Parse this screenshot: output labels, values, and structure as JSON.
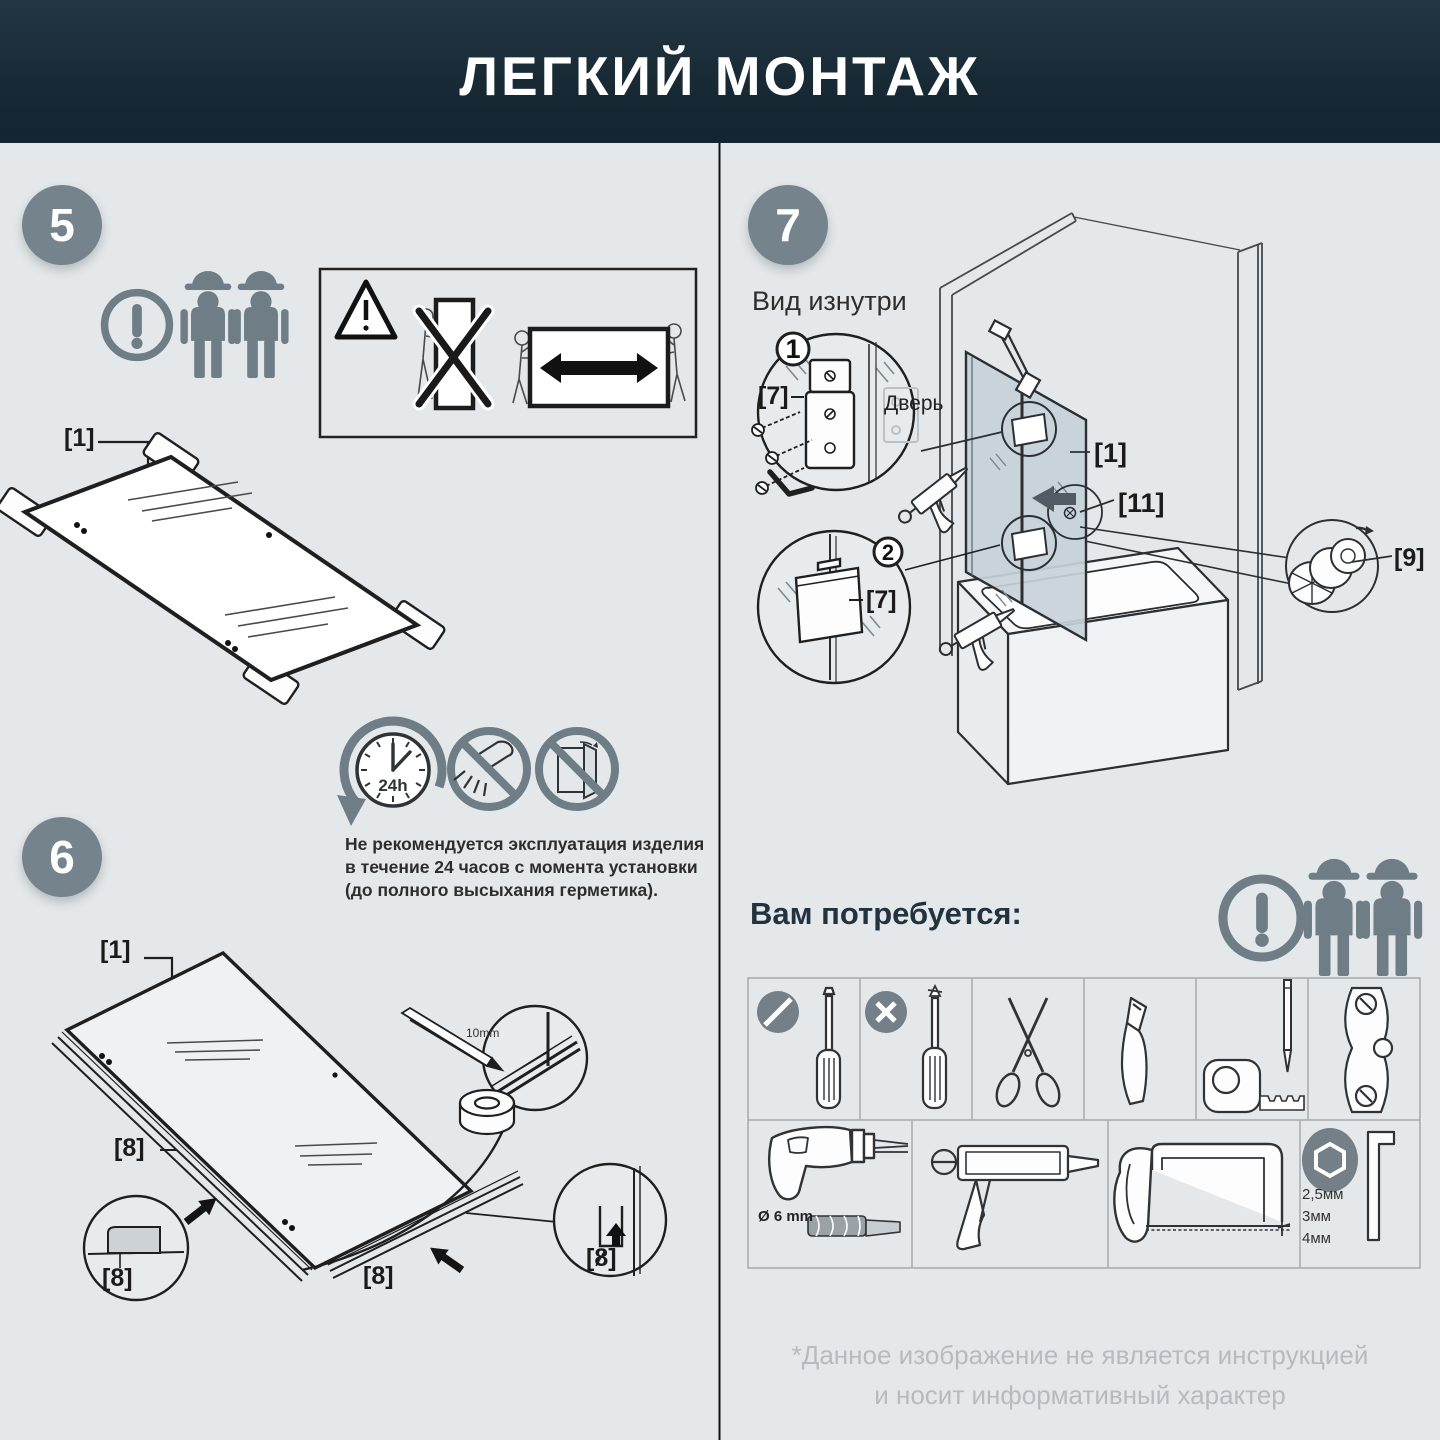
{
  "header": {
    "title": "ЛЕГКИЙ МОНТАЖ"
  },
  "colors": {
    "header_bg": "#182a35",
    "body_bg": "#e4e8ea",
    "badge_gray": "#75838c",
    "icon_gray": "#6e7d86",
    "line_art": "#2b2f33",
    "disclaimer_gray": "#b5bbc0"
  },
  "steps": {
    "step5": "5",
    "step6": "6",
    "step7": "7"
  },
  "step5": {
    "part_glass": "[1]",
    "icons": [
      "warning-icon",
      "two-workers-icon",
      "warning-triangle-icon",
      "no-vertical-carry-icon",
      "carry-horizontal-arrow-icon"
    ]
  },
  "curing": {
    "clock": "24h",
    "icons": [
      "clock-24h-icon",
      "no-shower-icon",
      "no-door-swing-icon"
    ],
    "note_lines": [
      "Не рекомендуется эксплуатация изделия",
      "в течение 24 часов с момента установки",
      "(до полного высыхания герметика)."
    ]
  },
  "step6": {
    "part_glass": "[1]",
    "part_seal": "[8]",
    "mark": "10mm",
    "icons": [
      "pencil-icon",
      "adhesive-tape-icon",
      "magnifier-circle",
      "seal-profile-detail",
      "block-arrow-icon"
    ]
  },
  "step7": {
    "view": "Вид изнутри",
    "door": "Дверь",
    "detail1": "1",
    "detail2": "2",
    "part_hinge": "[7]",
    "part_glass": "[1]",
    "part_knob": "[11]",
    "part_cap": "[9]",
    "icons": [
      "hinge-plate-detail",
      "hex-key-icon",
      "sealant-gun-icon",
      "bathtub-drawing",
      "cap-detail",
      "rotate-arrow-icon",
      "down-arrow-icon",
      "left-arrow-icon"
    ]
  },
  "tools": {
    "heading": "Вам потребуется:",
    "drill_diameter": "Ø 6 mm",
    "hex_sizes": [
      "2,5мм",
      "3мм",
      "4мм"
    ],
    "icons_row1": [
      "flat-screwdriver-icon",
      "phillips-screwdriver-icon",
      "scissors-icon",
      "utility-knife-icon",
      "tape-measure-pencil-icon",
      "bubble-level-icon"
    ],
    "icons_row2": [
      "drill-icon",
      "caulking-gun-icon",
      "hacksaw-icon",
      "hex-keys-icon"
    ],
    "header_icons": [
      "warning-icon",
      "two-workers-icon"
    ]
  },
  "footer": {
    "line1": "*Данное изображение не является инструкцией",
    "line2": "и носит информативный характер"
  }
}
